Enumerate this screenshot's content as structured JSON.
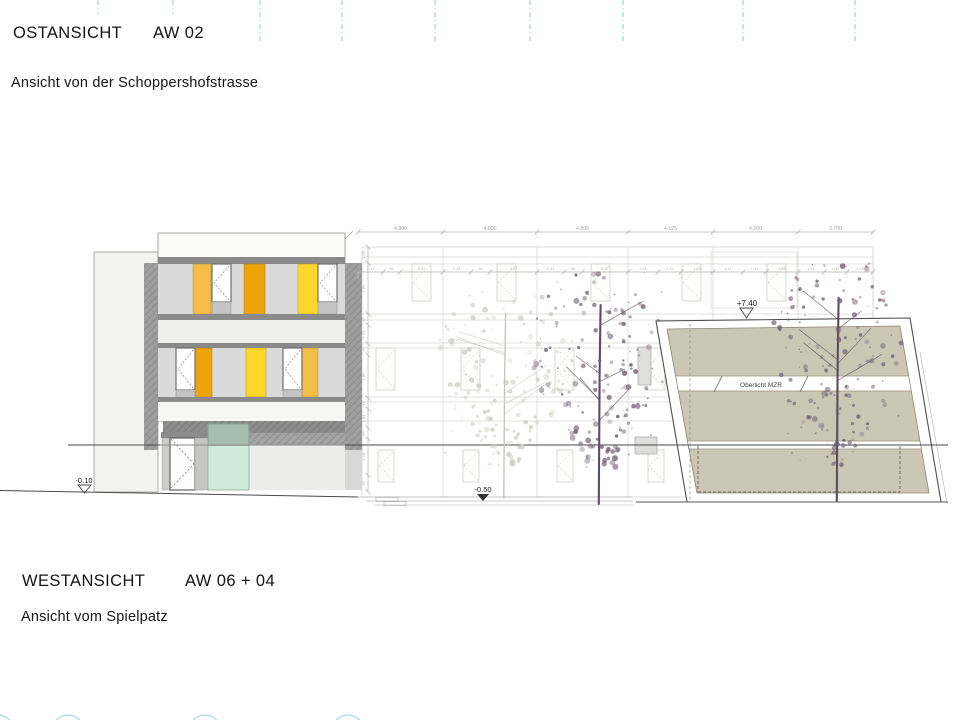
{
  "titles": {
    "top_heading": "OSTANSICHT",
    "top_code": "AW 02",
    "top_subtitle": "Ansicht von der Schoppershofstrasse",
    "bottom_heading": "WESTANSICHT",
    "bottom_code": "AW 06 + 04",
    "bottom_subtitle": "Ansicht vom Spielpatz"
  },
  "markers": {
    "level_minus_010": "-0.10",
    "level_minus_050": "-0.50",
    "level_plus_740": "+7.40",
    "oberlicht_label": "Oberlicht MZR"
  },
  "dimensions": {
    "top_row": [
      {
        "x1": 358,
        "x2": 443,
        "label": "4.800"
      },
      {
        "x1": 443,
        "x2": 537,
        "label": "4.800"
      },
      {
        "x1": 537,
        "x2": 628,
        "label": "4.805"
      },
      {
        "x1": 628,
        "x2": 713,
        "label": "4.125"
      },
      {
        "x1": 713,
        "x2": 798,
        "label": "4.200"
      },
      {
        "x1": 798,
        "x2": 873,
        "label": "3.700"
      }
    ],
    "second_row": [
      {
        "x1": 358,
        "x2": 383,
        "label": "1.41"
      },
      {
        "x1": 383,
        "x2": 400,
        "label": "96"
      },
      {
        "x1": 400,
        "x2": 443,
        "label": "2.27"
      },
      {
        "x1": 443,
        "x2": 471,
        "label": "1.41"
      },
      {
        "x1": 471,
        "x2": 490,
        "label": "96"
      },
      {
        "x1": 490,
        "x2": 537,
        "label": "2.27"
      },
      {
        "x1": 537,
        "x2": 564,
        "label": "1.41"
      },
      {
        "x1": 564,
        "x2": 582,
        "label": "96"
      },
      {
        "x1": 582,
        "x2": 628,
        "label": "2.27"
      },
      {
        "x1": 628,
        "x2": 658,
        "label": "1.41"
      },
      {
        "x1": 658,
        "x2": 681,
        "label": "1.11"
      },
      {
        "x1": 681,
        "x2": 713,
        "label": "1.54"
      },
      {
        "x1": 713,
        "x2": 743,
        "label": "1.41"
      },
      {
        "x1": 743,
        "x2": 766,
        "label": "1.11"
      },
      {
        "x1": 766,
        "x2": 798,
        "label": "1.59"
      },
      {
        "x1": 798,
        "x2": 824,
        "label": "1.41"
      },
      {
        "x1": 824,
        "x2": 847,
        "label": "1.11"
      },
      {
        "x1": 847,
        "x2": 873,
        "label": "1.05"
      }
    ],
    "vertical_row": [
      {
        "y1": 247,
        "y2": 263,
        "label": "1.05"
      },
      {
        "y1": 263,
        "y2": 314,
        "label": "1.85"
      },
      {
        "y1": 314,
        "y2": 325,
        "label": "45"
      },
      {
        "y1": 325,
        "y2": 344,
        "label": "1.04"
      },
      {
        "y1": 344,
        "y2": 355,
        "label": "45"
      },
      {
        "y1": 355,
        "y2": 398,
        "label": "1.90"
      },
      {
        "y1": 398,
        "y2": 409,
        "label": "45"
      },
      {
        "y1": 409,
        "y2": 428,
        "label": "1.04"
      },
      {
        "y1": 428,
        "y2": 439,
        "label": "45"
      },
      {
        "y1": 439,
        "y2": 475,
        "label": "1.38"
      },
      {
        "y1": 475,
        "y2": 492,
        "label": "46"
      }
    ]
  },
  "colors": {
    "accent_cyan": "#a9d9ec",
    "orange": "#efa40c",
    "amber": "#f4bd45",
    "yellow": "#ffd72b",
    "teal_glass": "#cfe9da",
    "beige": "#ccc6b5",
    "tree": "#6e5d6c",
    "tree_trunk": "#5d4d5b",
    "tree_faint": "#cdcdc6",
    "faint_line": "#d6d6d3"
  },
  "trees": [
    {
      "name": "faint-background-tree",
      "cx": 505,
      "top": 281,
      "ground": 498,
      "width": 128,
      "seed": 9,
      "faint": true
    },
    {
      "name": "large-tree-center",
      "cx": 600,
      "top": 270,
      "ground": 504,
      "width": 126,
      "seed": 3,
      "faint": false
    },
    {
      "name": "large-tree-right",
      "cx": 838,
      "top": 262,
      "ground": 501,
      "width": 122,
      "seed": 11,
      "faint": false
    }
  ],
  "decor": {
    "top_marks": [
      {
        "x": 98,
        "h": 14
      },
      {
        "x": 173,
        "h": 14
      },
      {
        "x": 260,
        "h": 42
      },
      {
        "x": 342,
        "h": 42
      },
      {
        "x": 435,
        "h": 42
      },
      {
        "x": 530,
        "h": 42
      },
      {
        "x": 623,
        "h": 42
      },
      {
        "x": 743,
        "h": 42
      },
      {
        "x": 855,
        "h": 42
      }
    ],
    "bottom_arcs": [
      {
        "cx": -2
      },
      {
        "cx": 68
      },
      {
        "cx": 205
      },
      {
        "cx": 348
      }
    ]
  }
}
